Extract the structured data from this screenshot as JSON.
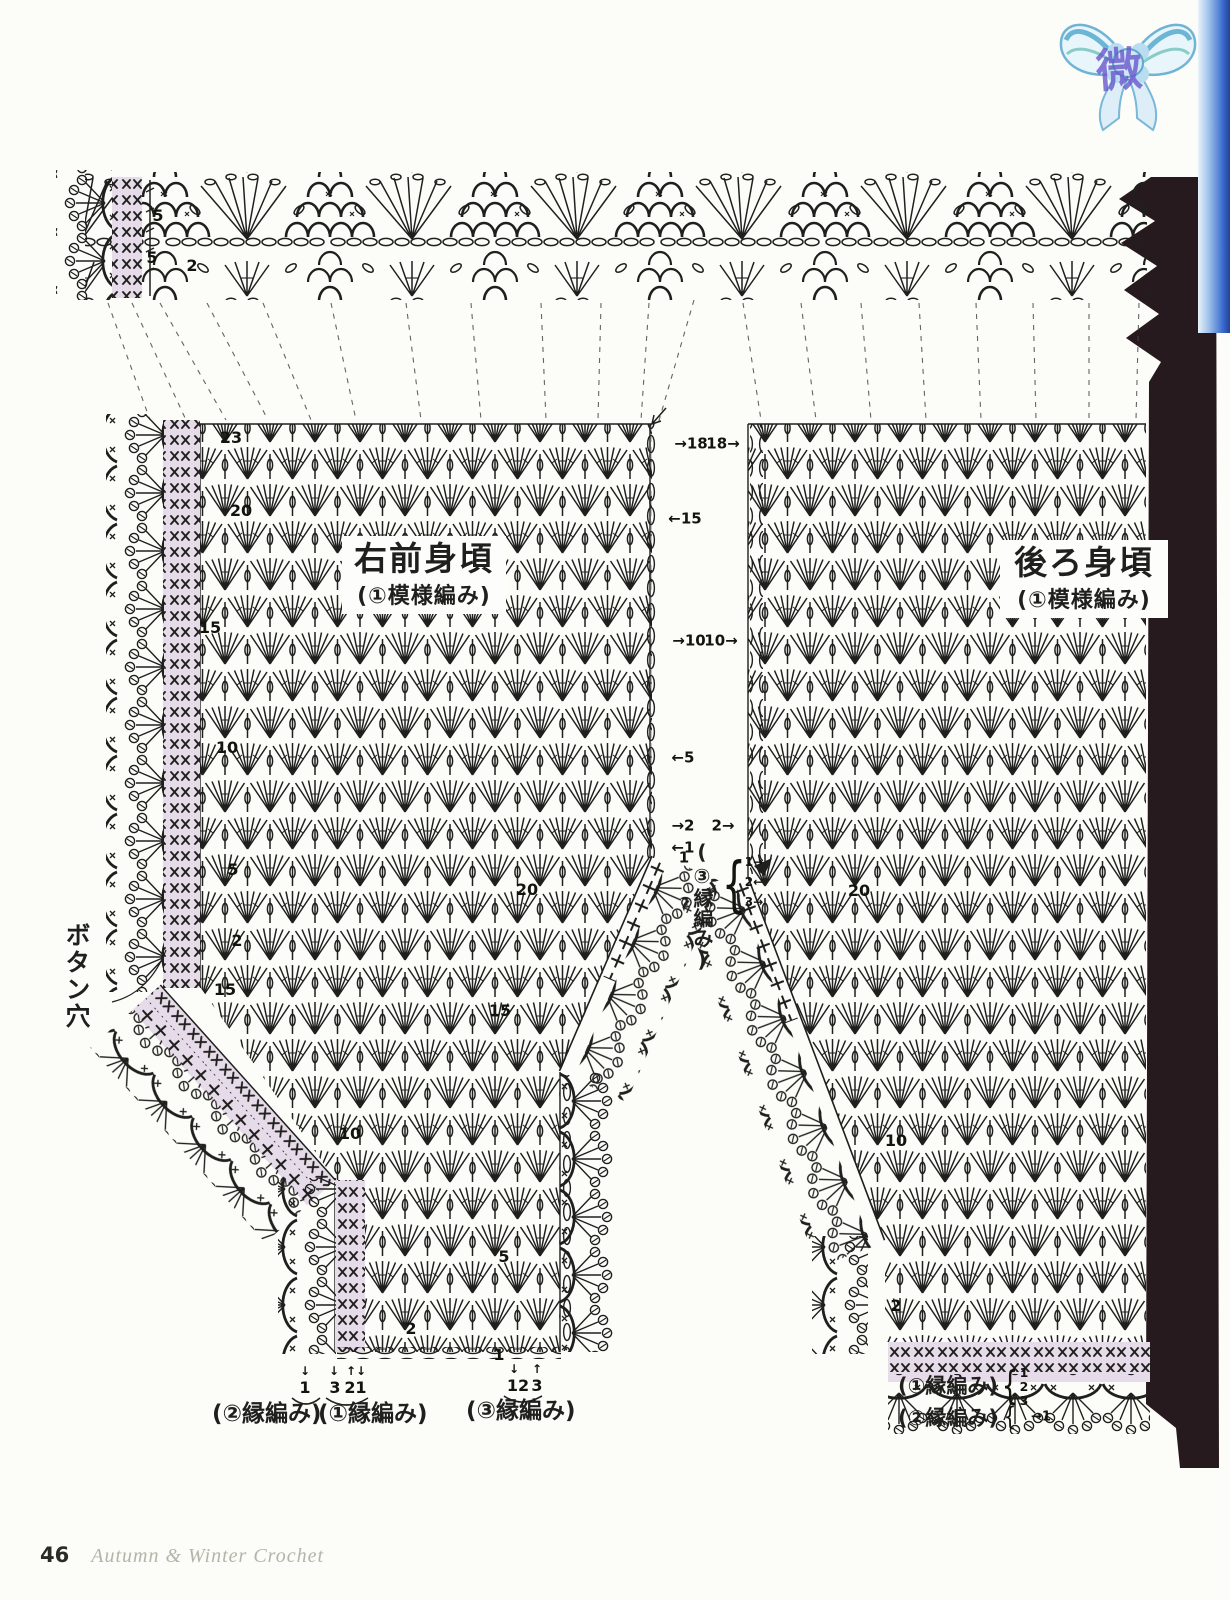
{
  "page": {
    "footer_page_number": "46",
    "footer_book_title": "Autumn & Winter Crochet",
    "watermark_character": "微"
  },
  "panels": {
    "left": {
      "title": "右前身頃",
      "subtitle": "(①模様編み)"
    },
    "right": {
      "title": "後ろ身頃",
      "subtitle": "(①模様編み)"
    }
  },
  "labels": {
    "buttonhole": "ボタン穴",
    "middle_edging_vertical": "(③縁編み)",
    "bottom_left_edging_2": "(②縁編み)",
    "bottom_left_edging_1": "(①縁編み)",
    "bottom_left_edging_3": "(③縁編み)",
    "bottom_right_edging_1": "(①縁編み)",
    "bottom_right_edging_2": "(②縁編み)"
  },
  "colors": {
    "ink": "#1f1f1d",
    "highlight_pink": "#e6dbe8",
    "page_edge_dark": "#261a1e",
    "page_edge_blue": "#2e66cf",
    "bow_blue": "#6fb4d6"
  },
  "annotations": [
    {
      "t": "5",
      "x": 158,
      "y": 216
    },
    {
      "t": "5",
      "x": 152,
      "y": 258
    },
    {
      "t": "2",
      "x": 192,
      "y": 266
    },
    {
      "t": "23",
      "x": 231,
      "y": 438
    },
    {
      "t": "20",
      "x": 241,
      "y": 511
    },
    {
      "t": "15",
      "x": 210,
      "y": 628
    },
    {
      "t": "10",
      "x": 227,
      "y": 748
    },
    {
      "t": "5",
      "x": 233,
      "y": 870
    },
    {
      "t": "2",
      "x": 237,
      "y": 941
    },
    {
      "t": "15",
      "x": 225,
      "y": 990
    },
    {
      "t": "10",
      "x": 350,
      "y": 1134
    },
    {
      "t": "5",
      "x": 504,
      "y": 1257
    },
    {
      "t": "2",
      "x": 411,
      "y": 1329
    },
    {
      "t": "1",
      "x": 499,
      "y": 1355
    },
    {
      "t": "20",
      "x": 527,
      "y": 890
    },
    {
      "t": "15",
      "x": 500,
      "y": 1011
    },
    {
      "t": "1",
      "x": 684,
      "y": 858,
      "fs": 15
    },
    {
      "t": "→18",
      "x": 691,
      "y": 444,
      "fs": 15
    },
    {
      "t": "←15",
      "x": 685,
      "y": 519,
      "fs": 15
    },
    {
      "t": "→10",
      "x": 689,
      "y": 641,
      "fs": 15
    },
    {
      "t": "←5",
      "x": 683,
      "y": 758,
      "fs": 15
    },
    {
      "t": "→2",
      "x": 683,
      "y": 826,
      "fs": 15
    },
    {
      "t": "←1",
      "x": 683,
      "y": 848,
      "fs": 15
    },
    {
      "t": "18→",
      "x": 723,
      "y": 444,
      "fs": 15
    },
    {
      "t": "10→",
      "x": 721,
      "y": 641,
      "fs": 15
    },
    {
      "t": "2→",
      "x": 723,
      "y": 826,
      "fs": 15
    },
    {
      "t": "20",
      "x": 859,
      "y": 891
    },
    {
      "t": "10",
      "x": 896,
      "y": 1141
    },
    {
      "t": "2",
      "x": 896,
      "y": 1306
    },
    {
      "t": "1→",
      "x": 754,
      "y": 862,
      "fs": 12
    },
    {
      "t": "2←",
      "x": 754,
      "y": 882,
      "fs": 12
    },
    {
      "t": "3→",
      "x": 754,
      "y": 902,
      "fs": 12
    },
    {
      "t": "{",
      "x": 734,
      "y": 884,
      "fs": 38,
      "sy": 1.6,
      "w": 400
    },
    {
      "t": "↓",
      "x": 305,
      "y": 1371,
      "fs": 12
    },
    {
      "t": "↓",
      "x": 334,
      "y": 1371,
      "fs": 12
    },
    {
      "t": "↑↓",
      "x": 356,
      "y": 1371,
      "fs": 12
    },
    {
      "t": "↓",
      "x": 514,
      "y": 1369,
      "fs": 12
    },
    {
      "t": "↑",
      "x": 537,
      "y": 1369,
      "fs": 12
    },
    {
      "t": "1",
      "x": 305,
      "y": 1388
    },
    {
      "t": "3",
      "x": 335,
      "y": 1388
    },
    {
      "t": "2",
      "x": 350,
      "y": 1388
    },
    {
      "t": "1",
      "x": 361,
      "y": 1388
    },
    {
      "t": "12",
      "x": 518,
      "y": 1386
    },
    {
      "t": "3",
      "x": 537,
      "y": 1386
    },
    {
      "t": "1",
      "x": 1024,
      "y": 1373,
      "fs": 12.5
    },
    {
      "t": "2",
      "x": 1024,
      "y": 1387,
      "fs": 12.5
    },
    {
      "t": "3",
      "x": 1024,
      "y": 1401,
      "fs": 12.5
    },
    {
      "t": "→1",
      "x": 1041,
      "y": 1417,
      "fs": 13
    },
    {
      "t": "{",
      "x": 1010,
      "y": 1387,
      "fs": 26,
      "sy": 1.5,
      "w": 400
    },
    {
      "t": "{",
      "x": 1010,
      "y": 1416,
      "fs": 20,
      "sy": 1.3,
      "w": 400
    }
  ]
}
